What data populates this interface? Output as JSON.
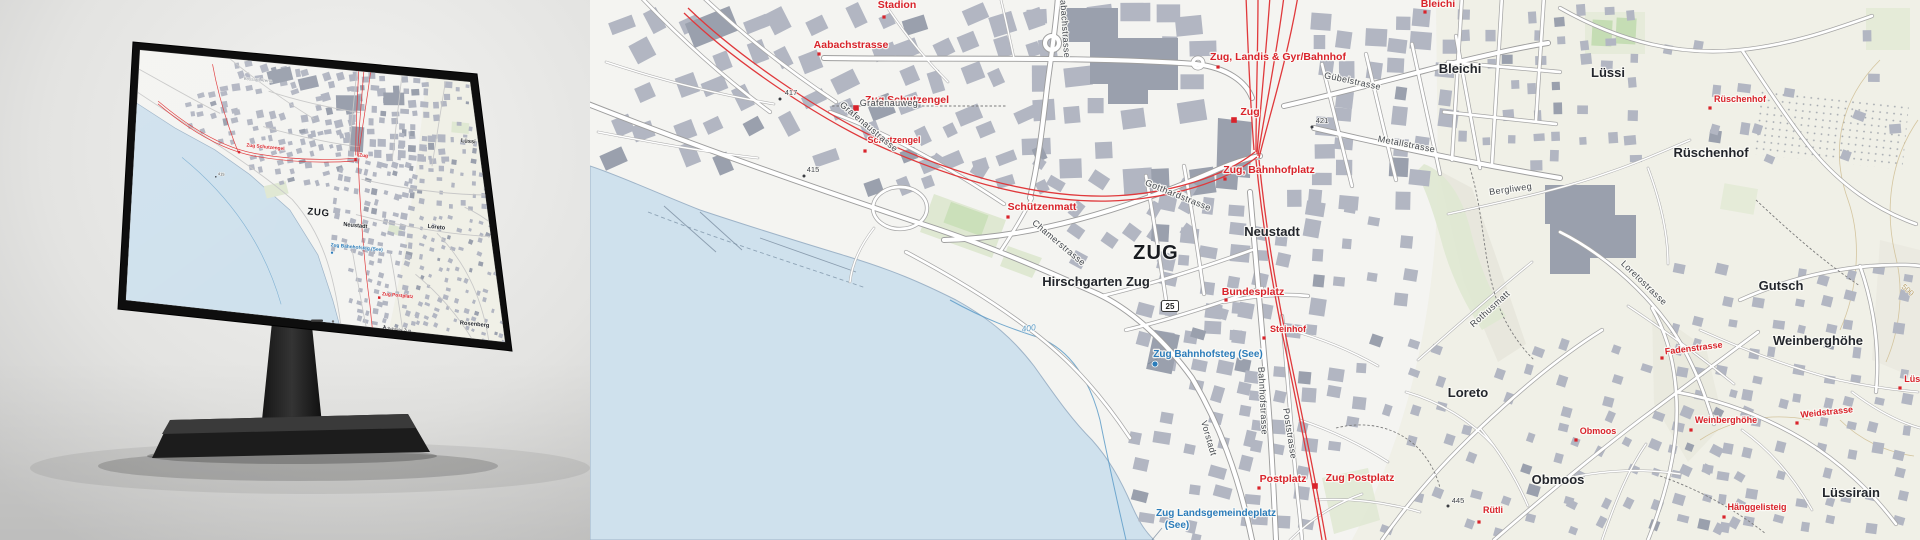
{
  "meta": {
    "alt": "swisstopo base map of Zug shown on a desktop monitor next to an enlarged map detail"
  },
  "colors": {
    "land": "#f4f4f1",
    "land_east": "#ecebdd",
    "water": "#cfe1ed",
    "shoreline": "#9fb4c8",
    "building": "#b2b6c2",
    "building_dark": "#9aa0ad",
    "road_casing": "#9e9e9e",
    "rail": "#e0393c",
    "label_red": "#d9232b",
    "label_blue": "#2b7cba",
    "park": "#dfe8d2",
    "pitch": "#c5ddb4",
    "contour": "#cfbd92",
    "depth": "#5e9cc8"
  },
  "map": {
    "shield": {
      "text": "25",
      "x": 1170,
      "y": 306
    },
    "labels": [
      {
        "t": "Stadion",
        "c": "red",
        "x": 897,
        "y": 8,
        "m": "dotr",
        "mx": 884,
        "my": 17
      },
      {
        "t": "417",
        "c": "elev",
        "x": 791,
        "y": 95,
        "m": "dot",
        "mx": 780,
        "my": 99
      },
      {
        "t": "Zug Schutzengel",
        "c": "red",
        "x": 907,
        "y": 103,
        "m": "sq",
        "mx": 856,
        "my": 108
      },
      {
        "t": "Schutzengel",
        "c": "redsm",
        "x": 894,
        "y": 143,
        "m": "dotr",
        "mx": 865,
        "my": 151
      },
      {
        "t": "415",
        "c": "elev",
        "x": 813,
        "y": 172,
        "m": "dot",
        "mx": 804,
        "my": 176
      },
      {
        "t": "Aabachstrasse",
        "c": "red",
        "x": 851,
        "y": 48,
        "m": "dotr",
        "mx": 819,
        "my": 54
      },
      {
        "t": "Aabachstrasse",
        "c": "street",
        "x": 1062,
        "y": 26,
        "r": 86
      },
      {
        "t": "Grafenauweg",
        "c": "street",
        "x": 889,
        "y": 106
      },
      {
        "t": "Grafenaustrasse",
        "c": "street",
        "x": 867,
        "y": 129,
        "r": 40
      },
      {
        "t": "Zug, Landis & Gyr/Bahnhof",
        "c": "red",
        "x": 1278,
        "y": 60,
        "m": "dotr",
        "mx": 1218,
        "my": 67
      },
      {
        "t": "Zug",
        "c": "red",
        "s": 12.5,
        "x": 1250,
        "y": 115,
        "m": "sq",
        "mx": 1234,
        "my": 120
      },
      {
        "t": "Gübelstrasse",
        "c": "street",
        "x": 1352,
        "y": 84,
        "r": 12
      },
      {
        "t": "421",
        "c": "elev",
        "x": 1322,
        "y": 123,
        "m": "dot",
        "mx": 1312,
        "my": 127
      },
      {
        "t": "Metallstrasse",
        "c": "street",
        "x": 1406,
        "y": 147,
        "r": 11
      },
      {
        "t": "Bleichi",
        "c": "red",
        "x": 1438,
        "y": 7,
        "m": "dotr",
        "mx": 1425,
        "my": 12
      },
      {
        "t": "Bleichi",
        "c": "place",
        "x": 1460,
        "y": 73
      },
      {
        "t": "Lüssi",
        "c": "place",
        "x": 1608,
        "y": 77
      },
      {
        "t": "Rüschenhof",
        "c": "redsm",
        "x": 1740,
        "y": 102,
        "m": "dotr",
        "mx": 1710,
        "my": 108
      },
      {
        "t": "Rüschenhof",
        "c": "place",
        "s": 12,
        "x": 1711,
        "y": 157
      },
      {
        "t": "Schützenmatt",
        "c": "red",
        "x": 1042,
        "y": 210,
        "m": "dotr",
        "mx": 1008,
        "my": 217
      },
      {
        "t": "Chamerstrasse",
        "c": "street",
        "x": 1057,
        "y": 245,
        "r": 40
      },
      {
        "t": "Gotthardstrasse",
        "c": "street",
        "x": 1177,
        "y": 198,
        "r": 22
      },
      {
        "t": "ZUG",
        "c": "city",
        "x": 1156,
        "y": 259
      },
      {
        "t": "Neustadt",
        "c": "place",
        "x": 1272,
        "y": 236
      },
      {
        "t": "Zug, Bahnhofplatz",
        "c": "red",
        "x": 1269,
        "y": 173,
        "m": "dotr",
        "mx": 1225,
        "my": 179
      },
      {
        "t": "Hirschgarten Zug",
        "c": "place",
        "s": 10.5,
        "x": 1096,
        "y": 286
      },
      {
        "t": "400",
        "c": "depthl",
        "x": 1029,
        "y": 331,
        "r": -8
      },
      {
        "t": "Zug Bahnhofsteg (See)",
        "c": "blue",
        "x": 1208,
        "y": 357,
        "m": "bluedot",
        "mx": 1155,
        "my": 364
      },
      {
        "t": "Bundesplatz",
        "c": "red",
        "x": 1253,
        "y": 295,
        "m": "dotr",
        "mx": 1226,
        "my": 300
      },
      {
        "t": "Steinhof",
        "c": "redsm",
        "x": 1288,
        "y": 332,
        "m": "dotr",
        "mx": 1264,
        "my": 338
      },
      {
        "t": "Vorstadt",
        "c": "street",
        "x": 1206,
        "y": 439,
        "r": 74
      },
      {
        "t": "Bahnhofstrasse",
        "c": "street",
        "x": 1260,
        "y": 401,
        "r": 87
      },
      {
        "t": "Poststrasse",
        "c": "street",
        "x": 1287,
        "y": 434,
        "r": 81
      },
      {
        "t": "Postplatz",
        "c": "red",
        "x": 1283,
        "y": 482,
        "m": "dotr",
        "mx": 1259,
        "my": 488
      },
      {
        "t": "Zug Postplatz",
        "c": "red",
        "s": 12,
        "x": 1360,
        "y": 481,
        "m": "sq",
        "mx": 1315,
        "my": 486
      },
      {
        "t": "Zug Landsgemeindeplatz",
        "c": "blue",
        "x": 1216,
        "y": 516
      },
      {
        "t": "(See)",
        "c": "blue",
        "x": 1177,
        "y": 528
      },
      {
        "t": "Loreto",
        "c": "place",
        "s": 14,
        "x": 1468,
        "y": 397
      },
      {
        "t": "Obmoos",
        "c": "redsm",
        "x": 1598,
        "y": 434,
        "m": "dotr",
        "mx": 1576,
        "my": 440
      },
      {
        "t": "Obmoos",
        "c": "place",
        "s": 14,
        "x": 1558,
        "y": 484
      },
      {
        "t": "Rütli",
        "c": "redsm",
        "x": 1493,
        "y": 513,
        "m": "dotr",
        "mx": 1479,
        "my": 522
      },
      {
        "t": "445",
        "c": "elev",
        "x": 1458,
        "y": 503,
        "m": "dot",
        "mx": 1448,
        "my": 506
      },
      {
        "t": "Rothusmatt",
        "c": "street",
        "x": 1492,
        "y": 311,
        "r": -42
      },
      {
        "t": "Loretostrasse",
        "c": "street",
        "x": 1642,
        "y": 285,
        "r": 44
      },
      {
        "t": "Bergliweg",
        "c": "street",
        "x": 1511,
        "y": 192,
        "r": -8
      },
      {
        "t": "Gutsch",
        "c": "place",
        "s": 14,
        "x": 1781,
        "y": 290
      },
      {
        "t": "Weinberghöhe",
        "c": "place",
        "s": 14,
        "x": 1818,
        "y": 345
      },
      {
        "t": "Fadenstrasse",
        "c": "redsm",
        "x": 1694,
        "y": 351,
        "r": -7,
        "m": "dotr",
        "mx": 1662,
        "my": 358
      },
      {
        "t": "Weinberghöhe",
        "c": "redsm",
        "x": 1726,
        "y": 423,
        "m": "dotr",
        "mx": 1691,
        "my": 430
      },
      {
        "t": "Weidstrasse",
        "c": "redsm",
        "x": 1827,
        "y": 415,
        "r": -6,
        "m": "dotr",
        "mx": 1797,
        "my": 423
      },
      {
        "t": "Hänggelisteig",
        "c": "redsm",
        "x": 1757,
        "y": 510,
        "m": "dotr",
        "mx": 1724,
        "my": 517
      },
      {
        "t": "Lüssirain",
        "c": "place",
        "s": 14,
        "x": 1851,
        "y": 497
      },
      {
        "t": "Lüssi",
        "c": "redsm",
        "x": 1916,
        "y": 382,
        "m": "dotr",
        "mx": 1900,
        "my": 388
      },
      {
        "t": "500",
        "c": "contour-l",
        "x": 1906,
        "y": 292,
        "r": 42
      }
    ]
  },
  "monitor": {
    "labels": [
      {
        "t": "Bossard Arena",
        "c": "gray",
        "x": 137,
        "y": 22
      },
      {
        "t": "Zug Schutzengel",
        "c": "redm",
        "x": 150,
        "y": 96,
        "m": "sqm",
        "mx": 120,
        "my": 103
      },
      {
        "t": "Zug",
        "c": "redm",
        "x": 263,
        "y": 95,
        "m": "sqm",
        "mx": 254,
        "my": 99
      },
      {
        "t": "ZUG",
        "c": "citym",
        "x": 215,
        "y": 165
      },
      {
        "t": "Neustadt",
        "c": "placem",
        "x": 258,
        "y": 174
      },
      {
        "t": "Altach",
        "c": "placem",
        "x": 421,
        "y": 25
      },
      {
        "t": "Lüssi",
        "c": "placem",
        "x": 382,
        "y": 68
      },
      {
        "t": "Loreto",
        "c": "placem",
        "x": 351,
        "y": 167
      },
      {
        "t": "Gütsch",
        "c": "placem",
        "x": 424,
        "y": 156
      },
      {
        "t": "Rosenberg",
        "c": "placem",
        "x": 401,
        "y": 271
      },
      {
        "t": "Lüssirain",
        "c": "placem",
        "x": 445,
        "y": 219
      },
      {
        "t": "415",
        "c": "elevm",
        "x": 101,
        "y": 131,
        "m": "dotm",
        "mx": 95,
        "my": 133
      },
      {
        "t": "Zug Bahnhofsteg (See)",
        "c": "bluem",
        "x": 261,
        "y": 198,
        "m": "bluedotm",
        "mx": 233,
        "my": 205
      },
      {
        "t": "Zug Postplatz",
        "c": "redm",
        "x": 311,
        "y": 247,
        "m": "sqm",
        "mx": 290,
        "my": 250
      },
      {
        "t": "Schloss Zug",
        "c": "poim",
        "x": 315,
        "y": 285,
        "m": "church",
        "mx": 298,
        "my": 284
      }
    ]
  }
}
